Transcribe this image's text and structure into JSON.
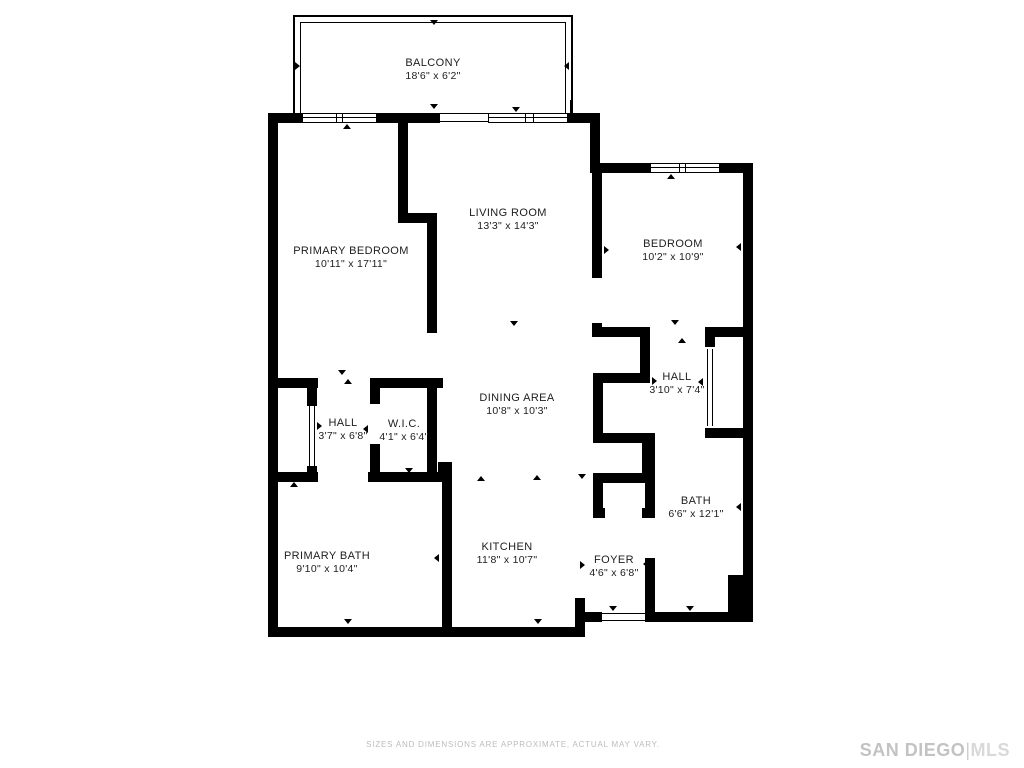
{
  "meta": {
    "background": "#ffffff",
    "wall_color": "#000000",
    "label_color": "#1d1d1d",
    "footer_color": "#bcbcbc",
    "brand_color": "#c3c3c3"
  },
  "rooms": [
    {
      "id": "balcony",
      "name": "BALCONY",
      "dims": "18'6\" x 6'2\"",
      "cx": 433,
      "cy": 70
    },
    {
      "id": "living-room",
      "name": "LIVING ROOM",
      "dims": "13'3\" x 14'3\"",
      "cx": 508,
      "cy": 220
    },
    {
      "id": "primary-bedroom",
      "name": "PRIMARY BEDROOM",
      "dims": "10'11\" x 17'11\"",
      "cx": 351,
      "cy": 258
    },
    {
      "id": "bedroom",
      "name": "BEDROOM",
      "dims": "10'2\" x 10'9\"",
      "cx": 673,
      "cy": 251
    },
    {
      "id": "hall-right",
      "name": "HALL",
      "dims": "3'10\" x 7'4\"",
      "cx": 677,
      "cy": 384
    },
    {
      "id": "dining-area",
      "name": "DINING AREA",
      "dims": "10'8\" x 10'3\"",
      "cx": 517,
      "cy": 405
    },
    {
      "id": "hall-left",
      "name": "HALL",
      "dims": "3'7\" x 6'8\"",
      "cx": 343,
      "cy": 430
    },
    {
      "id": "wic",
      "name": "W.I.C.",
      "dims": "4'1\" x 6'4\"",
      "cx": 404,
      "cy": 431
    },
    {
      "id": "primary-bath",
      "name": "PRIMARY BATH",
      "dims": "9'10\" x 10'4\"",
      "cx": 327,
      "cy": 563
    },
    {
      "id": "kitchen",
      "name": "KITCHEN",
      "dims": "11'8\" x 10'7\"",
      "cx": 507,
      "cy": 554
    },
    {
      "id": "foyer",
      "name": "FOYER",
      "dims": "4'6\" x 6'8\"",
      "cx": 614,
      "cy": 567
    },
    {
      "id": "bath",
      "name": "BATH",
      "dims": "6'6\" x 12'1\"",
      "cx": 696,
      "cy": 508
    }
  ],
  "balcony_rects": [
    {
      "x": 293,
      "y": 15,
      "w": 280,
      "h": 98,
      "kind": "outer"
    },
    {
      "x": 300,
      "y": 22,
      "w": 266,
      "h": 91,
      "kind": "inner"
    }
  ],
  "walls": [
    {
      "x": 268,
      "y": 113,
      "w": 34,
      "h": 10
    },
    {
      "x": 377,
      "y": 113,
      "w": 63,
      "h": 10
    },
    {
      "x": 568,
      "y": 113,
      "w": 32,
      "h": 10
    },
    {
      "x": 590,
      "y": 113,
      "w": 10,
      "h": 60
    },
    {
      "x": 600,
      "y": 163,
      "w": 50,
      "h": 10
    },
    {
      "x": 720,
      "y": 163,
      "w": 33,
      "h": 10
    },
    {
      "x": 743,
      "y": 163,
      "w": 10,
      "h": 417
    },
    {
      "x": 728,
      "y": 575,
      "w": 25,
      "h": 47
    },
    {
      "x": 645,
      "y": 612,
      "w": 83,
      "h": 10
    },
    {
      "x": 583,
      "y": 612,
      "w": 19,
      "h": 10
    },
    {
      "x": 575,
      "y": 598,
      "w": 10,
      "h": 39
    },
    {
      "x": 268,
      "y": 627,
      "w": 317,
      "h": 10
    },
    {
      "x": 268,
      "y": 113,
      "w": 10,
      "h": 524
    },
    {
      "x": 398,
      "y": 123,
      "w": 10,
      "h": 100
    },
    {
      "x": 398,
      "y": 213,
      "w": 39,
      "h": 10
    },
    {
      "x": 427,
      "y": 213,
      "w": 10,
      "h": 120
    },
    {
      "x": 427,
      "y": 378,
      "w": 10,
      "h": 104
    },
    {
      "x": 268,
      "y": 378,
      "w": 50,
      "h": 10
    },
    {
      "x": 372,
      "y": 378,
      "w": 71,
      "h": 10
    },
    {
      "x": 307,
      "y": 380,
      "w": 10,
      "h": 26
    },
    {
      "x": 307,
      "y": 466,
      "w": 10,
      "h": 16
    },
    {
      "x": 268,
      "y": 472,
      "w": 50,
      "h": 10
    },
    {
      "x": 368,
      "y": 472,
      "w": 84,
      "h": 10
    },
    {
      "x": 370,
      "y": 378,
      "w": 10,
      "h": 26
    },
    {
      "x": 370,
      "y": 444,
      "w": 10,
      "h": 38
    },
    {
      "x": 438,
      "y": 462,
      "w": 14,
      "h": 20
    },
    {
      "x": 442,
      "y": 475,
      "w": 10,
      "h": 162
    },
    {
      "x": 592,
      "y": 172,
      "w": 10,
      "h": 106
    },
    {
      "x": 592,
      "y": 323,
      "w": 10,
      "h": 14
    },
    {
      "x": 593,
      "y": 327,
      "w": 57,
      "h": 10
    },
    {
      "x": 705,
      "y": 327,
      "w": 42,
      "h": 10
    },
    {
      "x": 640,
      "y": 327,
      "w": 10,
      "h": 56
    },
    {
      "x": 593,
      "y": 373,
      "w": 52,
      "h": 10
    },
    {
      "x": 593,
      "y": 383,
      "w": 10,
      "h": 55
    },
    {
      "x": 593,
      "y": 433,
      "w": 59,
      "h": 10
    },
    {
      "x": 642,
      "y": 433,
      "w": 10,
      "h": 50
    },
    {
      "x": 593,
      "y": 473,
      "w": 59,
      "h": 10
    },
    {
      "x": 593,
      "y": 483,
      "w": 10,
      "h": 35
    },
    {
      "x": 593,
      "y": 508,
      "w": 12,
      "h": 10
    },
    {
      "x": 642,
      "y": 508,
      "w": 13,
      "h": 10
    },
    {
      "x": 645,
      "y": 433,
      "w": 10,
      "h": 85
    },
    {
      "x": 645,
      "y": 558,
      "w": 10,
      "h": 64
    },
    {
      "x": 705,
      "y": 327,
      "w": 10,
      "h": 20
    },
    {
      "x": 705,
      "y": 428,
      "w": 42,
      "h": 10
    }
  ],
  "windows": [
    {
      "x": 302,
      "y": 113,
      "w": 75,
      "h": 10,
      "mullions": [
        33,
        39
      ]
    },
    {
      "x": 488,
      "y": 113,
      "w": 80,
      "h": 10,
      "mullions": [
        36,
        44
      ]
    },
    {
      "x": 650,
      "y": 163,
      "w": 70,
      "h": 10,
      "mullions": [
        28,
        34
      ]
    }
  ],
  "door_lines": [
    {
      "x": 309,
      "y": 406,
      "w": 1,
      "h": 60
    },
    {
      "x": 314,
      "y": 406,
      "w": 1,
      "h": 60
    },
    {
      "x": 707,
      "y": 349,
      "w": 1,
      "h": 77
    },
    {
      "x": 712,
      "y": 349,
      "w": 1,
      "h": 77
    },
    {
      "x": 440,
      "y": 113,
      "w": 48,
      "h": 1
    },
    {
      "x": 440,
      "y": 121,
      "w": 48,
      "h": 1
    },
    {
      "x": 602,
      "y": 613,
      "w": 43,
      "h": 1
    },
    {
      "x": 602,
      "y": 620,
      "w": 43,
      "h": 1
    },
    {
      "x": 293,
      "y": 100,
      "w": 2,
      "h": 13
    },
    {
      "x": 570,
      "y": 100,
      "w": 3,
      "h": 13
    }
  ],
  "ticks": [
    {
      "x": 430,
      "y": 104,
      "d": "down"
    },
    {
      "x": 512,
      "y": 107,
      "d": "down"
    },
    {
      "x": 343,
      "y": 124,
      "d": "up"
    },
    {
      "x": 667,
      "y": 174,
      "d": "up"
    },
    {
      "x": 430,
      "y": 20,
      "d": "down"
    },
    {
      "x": 295,
      "y": 62,
      "d": "right"
    },
    {
      "x": 564,
      "y": 62,
      "d": "left"
    },
    {
      "x": 271,
      "y": 294,
      "d": "right"
    },
    {
      "x": 428,
      "y": 294,
      "d": "left"
    },
    {
      "x": 604,
      "y": 246,
      "d": "right"
    },
    {
      "x": 736,
      "y": 243,
      "d": "left"
    },
    {
      "x": 671,
      "y": 320,
      "d": "down"
    },
    {
      "x": 678,
      "y": 338,
      "d": "up"
    },
    {
      "x": 510,
      "y": 321,
      "d": "down"
    },
    {
      "x": 533,
      "y": 475,
      "d": "up"
    },
    {
      "x": 477,
      "y": 476,
      "d": "up"
    },
    {
      "x": 578,
      "y": 474,
      "d": "down"
    },
    {
      "x": 344,
      "y": 619,
      "d": "down"
    },
    {
      "x": 534,
      "y": 619,
      "d": "down"
    },
    {
      "x": 609,
      "y": 606,
      "d": "down"
    },
    {
      "x": 686,
      "y": 606,
      "d": "down"
    },
    {
      "x": 736,
      "y": 503,
      "d": "left"
    },
    {
      "x": 643,
      "y": 560,
      "d": "left"
    },
    {
      "x": 580,
      "y": 561,
      "d": "right"
    },
    {
      "x": 317,
      "y": 422,
      "d": "right"
    },
    {
      "x": 363,
      "y": 425,
      "d": "left"
    },
    {
      "x": 405,
      "y": 381,
      "d": "up"
    },
    {
      "x": 405,
      "y": 468,
      "d": "down"
    },
    {
      "x": 338,
      "y": 370,
      "d": "down"
    },
    {
      "x": 344,
      "y": 379,
      "d": "up"
    },
    {
      "x": 290,
      "y": 482,
      "d": "up"
    },
    {
      "x": 271,
      "y": 557,
      "d": "right"
    },
    {
      "x": 434,
      "y": 554,
      "d": "left"
    },
    {
      "x": 652,
      "y": 377,
      "d": "right"
    },
    {
      "x": 698,
      "y": 378,
      "d": "left"
    }
  ],
  "footer": {
    "disclaimer": "SIZES AND DIMENSIONS ARE APPROXIMATE, ACTUAL MAY VARY.",
    "brand_primary": "SAN DIEGO",
    "brand_divider": "|",
    "brand_secondary": "MLS"
  }
}
